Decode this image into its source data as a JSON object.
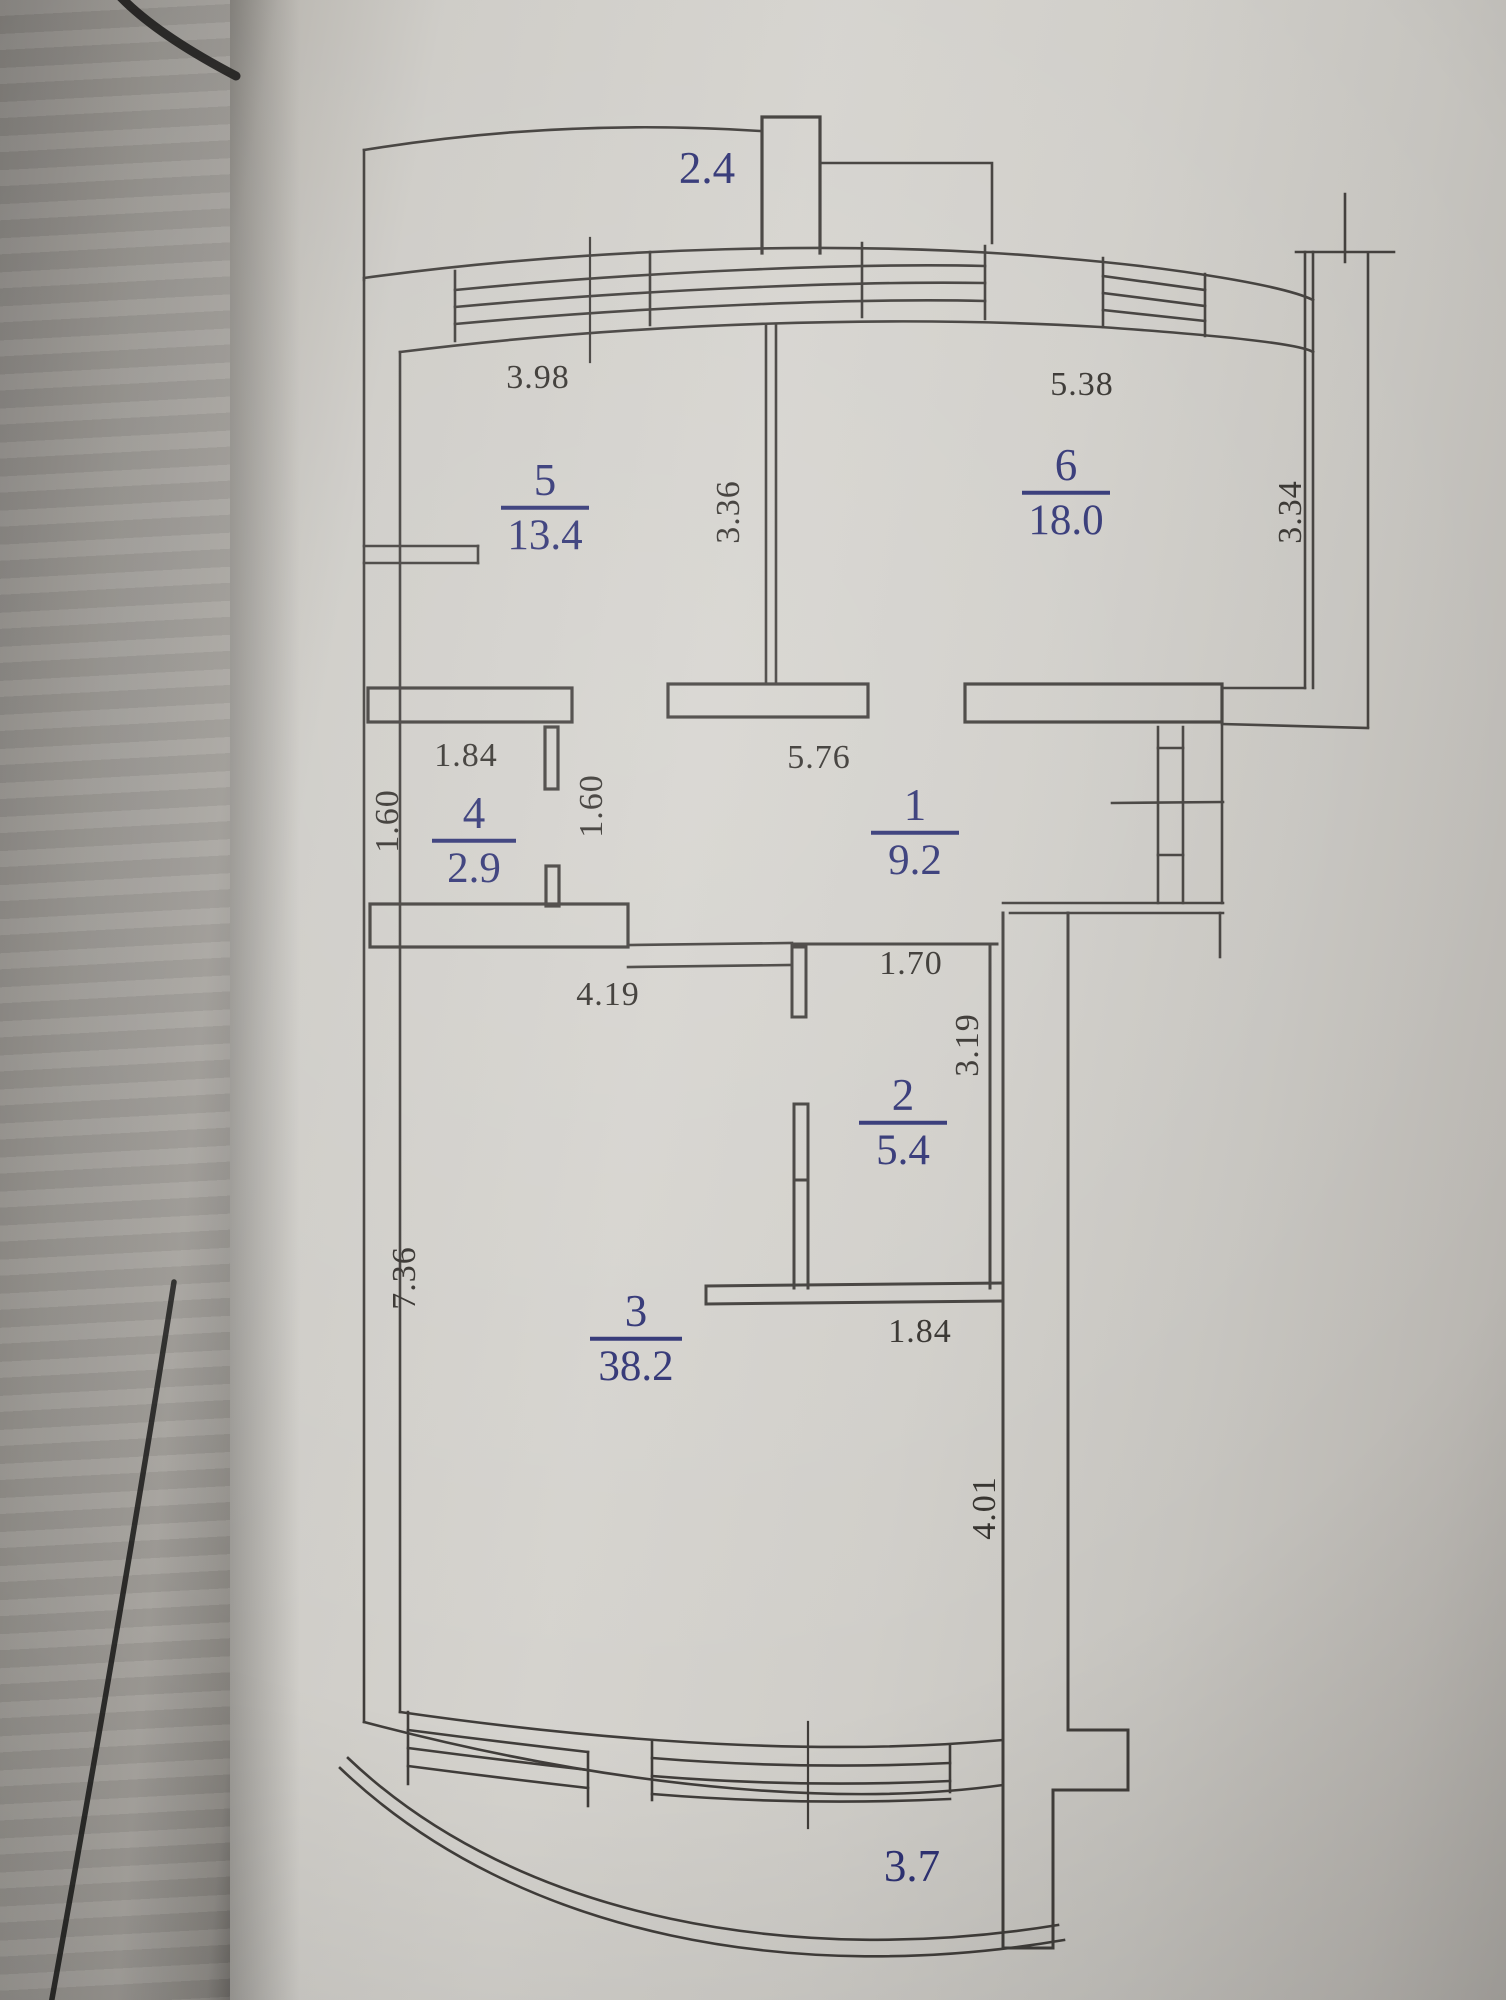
{
  "colors": {
    "ink": "#403d3a",
    "accent_blue": "#2e3273",
    "paper": "#d0cec9"
  },
  "floorplan": {
    "rooms": [
      {
        "id": "5",
        "number": "5",
        "area": "13.4",
        "x": 545,
        "y": 507,
        "bar_w": 88
      },
      {
        "id": "6",
        "number": "6",
        "area": "18.0",
        "x": 1066,
        "y": 492,
        "bar_w": 88
      },
      {
        "id": "4",
        "number": "4",
        "area": "2.9",
        "x": 474,
        "y": 840,
        "bar_w": 84
      },
      {
        "id": "1",
        "number": "1",
        "area": "9.2",
        "x": 915,
        "y": 832,
        "bar_w": 88
      },
      {
        "id": "2",
        "number": "2",
        "area": "5.4",
        "x": 903,
        "y": 1122,
        "bar_w": 88
      },
      {
        "id": "3",
        "number": "3",
        "area": "38.2",
        "x": 636,
        "y": 1338,
        "bar_w": 92
      }
    ],
    "balcony_areas": [
      {
        "value": "2.4",
        "x": 707,
        "y": 168
      },
      {
        "value": "3.7",
        "x": 912,
        "y": 1866
      }
    ],
    "dimensions": [
      {
        "value": "3.98",
        "x": 538,
        "y": 378,
        "vertical": false
      },
      {
        "value": "5.38",
        "x": 1082,
        "y": 385,
        "vertical": false
      },
      {
        "value": "3.36",
        "x": 729,
        "y": 512,
        "vertical": true
      },
      {
        "value": "3.34",
        "x": 1291,
        "y": 512,
        "vertical": true
      },
      {
        "value": "1.84",
        "x": 466,
        "y": 756,
        "vertical": false
      },
      {
        "value": "1.60",
        "x": 388,
        "y": 821,
        "vertical": true
      },
      {
        "value": "1.60",
        "x": 592,
        "y": 806,
        "vertical": true
      },
      {
        "value": "5.76",
        "x": 819,
        "y": 758,
        "vertical": false
      },
      {
        "value": "1.70",
        "x": 911,
        "y": 964,
        "vertical": false
      },
      {
        "value": "3.19",
        "x": 968,
        "y": 1045,
        "vertical": true
      },
      {
        "value": "4.19",
        "x": 608,
        "y": 995,
        "vertical": false
      },
      {
        "value": "7.36",
        "x": 405,
        "y": 1278,
        "vertical": true
      },
      {
        "value": "1.84",
        "x": 920,
        "y": 1332,
        "vertical": false
      },
      {
        "value": "4.01",
        "x": 985,
        "y": 1508,
        "vertical": true
      }
    ]
  }
}
